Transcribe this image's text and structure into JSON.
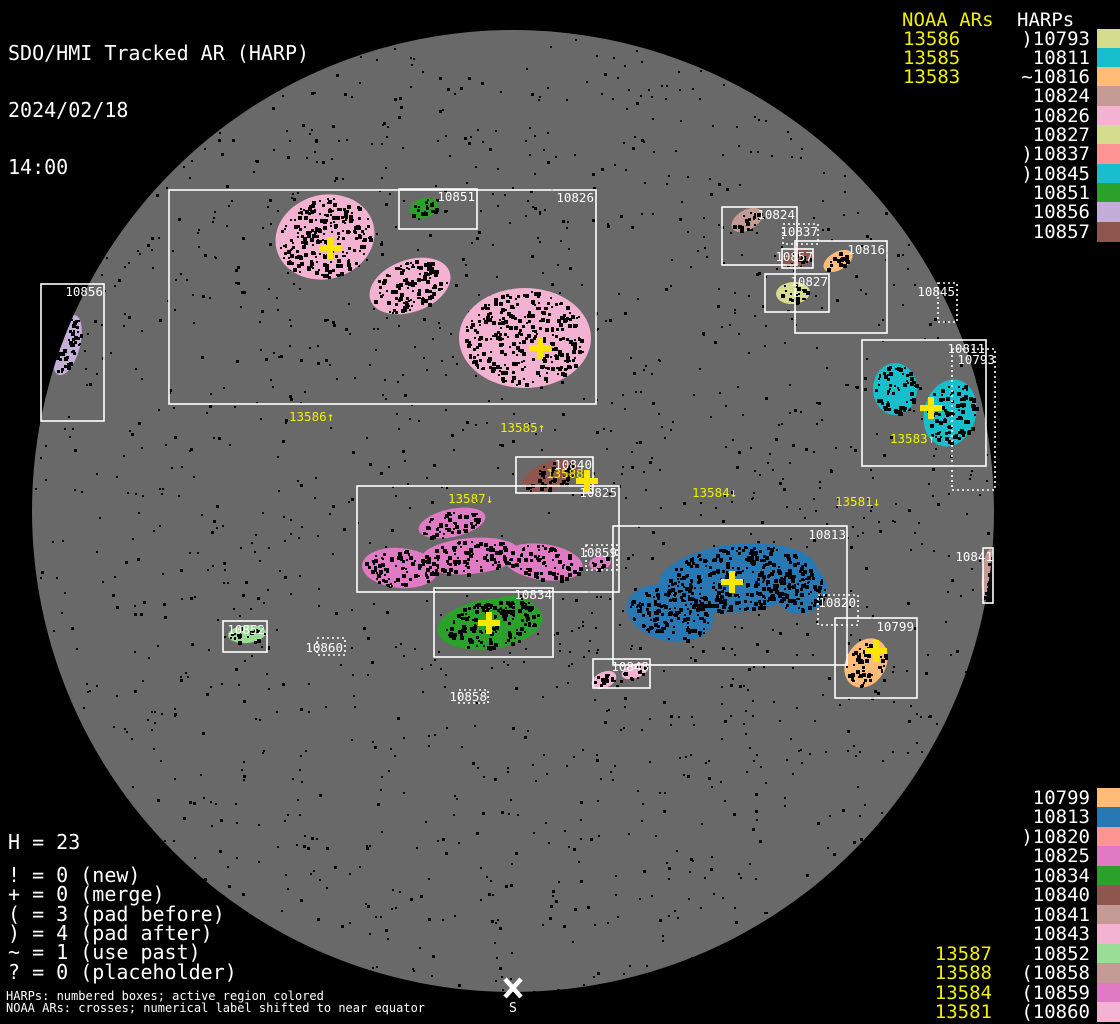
{
  "header": {
    "title": "SDO/HMI Tracked AR (HARP)",
    "date": "2024/02/18",
    "time": "14:00"
  },
  "columns": {
    "noaa_header": "NOAA ARs",
    "harp_header": "HARPs"
  },
  "colors": {
    "background": "#000000",
    "disk": "#696969",
    "box_stroke": "#ffffff",
    "noaa_yellow": "#f0f000",
    "cross_yellow": "#ffe600",
    "speckle": "#000000"
  },
  "disk": {
    "cx": 513,
    "cy": 511,
    "r": 481
  },
  "south": {
    "x": 513,
    "y": 988,
    "label": "S"
  },
  "stats": {
    "h": "H = 23",
    "flags": [
      "! = 0 (new)",
      "+ = 0 (merge)",
      "( = 3 (pad before)",
      ") = 4 (pad after)",
      "~ = 1 (use past)",
      "? = 0 (placeholder)"
    ]
  },
  "footer": {
    "line1": "HARPs: numbered boxes; active region colored",
    "line2": "NOAA ARs: crosses; numerical label shifted to near equator"
  },
  "legend_top": [
    {
      "noaa": "13586",
      "harp": ")10793",
      "color": "#d6dc8e"
    },
    {
      "noaa": "13585",
      "harp": "10811",
      "color": "#17becb"
    },
    {
      "noaa": "13583",
      "harp": "~10816",
      "color": "#ffbc78"
    },
    {
      "noaa": "",
      "harp": "10824",
      "color": "#c49a94"
    },
    {
      "noaa": "",
      "harp": "10826",
      "color": "#f4b2d2"
    },
    {
      "noaa": "",
      "harp": "10827",
      "color": "#d6dc8e"
    },
    {
      "noaa": "",
      "harp": ")10837",
      "color": "#ff9494"
    },
    {
      "noaa": "",
      "harp": ")10845",
      "color": "#17becb"
    },
    {
      "noaa": "",
      "harp": "10851",
      "color": "#2ba02b"
    },
    {
      "noaa": "",
      "harp": "10856",
      "color": "#c2aed6"
    },
    {
      "noaa": "",
      "harp": "10857",
      "color": "#8e564c"
    }
  ],
  "legend_bottom": [
    {
      "noaa": "",
      "harp": "10799",
      "color": "#ffbc78"
    },
    {
      "noaa": "",
      "harp": "10813",
      "color": "#2878b4"
    },
    {
      "noaa": "",
      "harp": ")10820",
      "color": "#ff9494"
    },
    {
      "noaa": "",
      "harp": "10825",
      "color": "#e07ac4"
    },
    {
      "noaa": "",
      "harp": "10834",
      "color": "#2ba02b"
    },
    {
      "noaa": "",
      "harp": "10840",
      "color": "#8e564c"
    },
    {
      "noaa": "",
      "harp": "10841",
      "color": "#c49a94"
    },
    {
      "noaa": "",
      "harp": "10843",
      "color": "#f4b2d2"
    },
    {
      "noaa": "13587",
      "harp": "10852",
      "color": "#9add96"
    },
    {
      "noaa": "13588",
      "harp": "(10858",
      "color": "#c49a94"
    },
    {
      "noaa": "13584",
      "harp": "(10859",
      "color": "#e07ac4"
    },
    {
      "noaa": "13581",
      "harp": "(10860",
      "color": "#f4b2d2"
    }
  ],
  "harps": [
    {
      "id": "10826",
      "box": [
        169,
        190,
        427,
        214
      ],
      "style": "solid",
      "label_x": 594,
      "label_y": 202,
      "color": "#f4b2d2",
      "ellipses": [
        [
          325,
          237,
          50,
          42,
          -15
        ],
        [
          410,
          286,
          42,
          26,
          -20
        ],
        [
          525,
          338,
          66,
          50,
          0
        ]
      ]
    },
    {
      "id": "10851",
      "box": [
        399,
        189,
        78,
        40
      ],
      "style": "solid",
      "label_x": 475,
      "label_y": 201,
      "color": "#2ba02b",
      "ellipses": [
        [
          424,
          208,
          15,
          10,
          -15
        ]
      ]
    },
    {
      "id": "10856",
      "box": [
        41,
        284,
        63,
        137
      ],
      "style": "solid",
      "label_x": 103,
      "label_y": 296,
      "color": "#c2aed6",
      "ellipses": [
        [
          67,
          345,
          13,
          31,
          15
        ]
      ]
    },
    {
      "id": "10824",
      "box": [
        722,
        207,
        75,
        58
      ],
      "style": "solid",
      "label_x": 795,
      "label_y": 219,
      "color": "#c49a94",
      "ellipses": [
        [
          747,
          220,
          17,
          10,
          -30
        ]
      ]
    },
    {
      "id": "10837",
      "box": [
        783,
        224,
        35,
        20
      ],
      "style": "dotted",
      "label_x": 818,
      "label_y": 236,
      "color": "#ff9494",
      "ellipses": []
    },
    {
      "id": "10857",
      "box": [
        782,
        249,
        31,
        19
      ],
      "style": "solid",
      "label_x": 813,
      "label_y": 261,
      "color": "#8e564c",
      "ellipses": [
        [
          798,
          258,
          16,
          8,
          -10
        ]
      ]
    },
    {
      "id": "10816",
      "box": [
        795,
        241,
        92,
        92
      ],
      "style": "solid",
      "label_x": 885,
      "label_y": 254,
      "color": "#ffbc78",
      "ellipses": [
        [
          838,
          261,
          16,
          9,
          -30
        ]
      ]
    },
    {
      "id": "10827",
      "box": [
        765,
        274,
        64,
        38
      ],
      "style": "solid",
      "label_x": 828,
      "label_y": 286,
      "color": "#d6dc8e",
      "ellipses": [
        [
          793,
          293,
          17,
          11,
          -5
        ]
      ]
    },
    {
      "id": "10845",
      "box": [
        938,
        283,
        19,
        39
      ],
      "style": "dotted",
      "label_x": 955,
      "label_y": 296,
      "color": "#17becb",
      "ellipses": []
    },
    {
      "id": "10811",
      "box": [
        862,
        340,
        124,
        126
      ],
      "style": "solid",
      "label_x": 985,
      "label_y": 353,
      "color": "#17becb",
      "ellipses": [
        [
          895,
          389,
          22,
          26,
          0
        ],
        [
          950,
          413,
          26,
          34,
          15
        ]
      ]
    },
    {
      "id": "10793",
      "box": [
        952,
        349,
        43,
        141
      ],
      "style": "dotted",
      "label_x": 995,
      "label_y": 364,
      "color": "#d6dc8e",
      "ellipses": []
    },
    {
      "id": "10840",
      "box": [
        516,
        457,
        77,
        36
      ],
      "style": "solid",
      "label_x": 592,
      "label_y": 469,
      "color": "#8e564c",
      "ellipses": [
        [
          550,
          476,
          29,
          14,
          -20
        ]
      ]
    },
    {
      "id": "10825",
      "box": [
        357,
        486,
        262,
        106
      ],
      "style": "solid",
      "label_x": 617,
      "label_y": 497,
      "color": "#e07ac4",
      "ellipses": [
        [
          452,
          523,
          34,
          14,
          -12
        ],
        [
          400,
          568,
          38,
          20,
          5
        ],
        [
          470,
          556,
          50,
          18,
          -5
        ],
        [
          543,
          562,
          40,
          18,
          8
        ]
      ]
    },
    {
      "id": "10859",
      "box": [
        586,
        545,
        31,
        25
      ],
      "style": "dotted",
      "label_x": 617,
      "label_y": 557,
      "color": "#e07ac4",
      "ellipses": [
        [
          600,
          563,
          11,
          7,
          -10
        ]
      ]
    },
    {
      "id": "10834",
      "box": [
        434,
        588,
        119,
        69
      ],
      "style": "solid",
      "label_x": 552,
      "label_y": 599,
      "color": "#2ba02b",
      "ellipses": [
        [
          490,
          624,
          53,
          25,
          -8
        ],
        [
          512,
          607,
          22,
          11,
          0
        ]
      ]
    },
    {
      "id": "10843",
      "box": [
        593,
        659,
        57,
        29
      ],
      "style": "solid",
      "label_x": 649,
      "label_y": 671,
      "color": "#f4b2d2",
      "ellipses": [
        [
          604,
          680,
          13,
          8,
          -25
        ],
        [
          635,
          671,
          14,
          7,
          -20
        ]
      ]
    },
    {
      "id": "10813",
      "box": [
        613,
        526,
        234,
        139
      ],
      "style": "solid",
      "label_x": 846,
      "label_y": 539,
      "color": "#2878b4",
      "ellipses": [
        [
          738,
          578,
          80,
          34,
          -6
        ],
        [
          670,
          613,
          44,
          28,
          12
        ],
        [
          800,
          589,
          27,
          25,
          0
        ]
      ]
    },
    {
      "id": "10820",
      "box": [
        818,
        595,
        40,
        30
      ],
      "style": "dotted",
      "label_x": 856,
      "label_y": 607,
      "color": "#ff9494",
      "ellipses": []
    },
    {
      "id": "10799",
      "box": [
        835,
        618,
        82,
        80
      ],
      "style": "solid",
      "label_x": 914,
      "label_y": 631,
      "color": "#ffbc78",
      "ellipses": [
        [
          866,
          663,
          20,
          26,
          30
        ]
      ]
    },
    {
      "id": "10852",
      "box": [
        223,
        621,
        44,
        31
      ],
      "style": "solid",
      "label_x": 265,
      "label_y": 634,
      "color": "#9add96",
      "ellipses": [
        [
          247,
          634,
          19,
          9,
          -5
        ]
      ]
    },
    {
      "id": "10860",
      "box": [
        317,
        638,
        28,
        17
      ],
      "style": "dotted",
      "label_x": 343,
      "label_y": 652,
      "color": "#f4b2d2",
      "ellipses": []
    },
    {
      "id": "10858",
      "box": [
        459,
        690,
        29,
        13
      ],
      "style": "dotted",
      "label_x": 487,
      "label_y": 701,
      "color": "#c49a94",
      "ellipses": []
    },
    {
      "id": "10841",
      "box": [
        983,
        548,
        10,
        55
      ],
      "style": "solid",
      "label_x": 993,
      "label_y": 561,
      "color": "#c49a94",
      "ellipses": [
        [
          988,
          575,
          6,
          26,
          5
        ]
      ]
    }
  ],
  "noaa_crosses": [
    [
      330,
      248
    ],
    [
      540,
      348
    ],
    [
      931,
      408
    ],
    [
      587,
      481
    ],
    [
      732,
      582
    ],
    [
      489,
      623
    ],
    [
      876,
      651
    ]
  ],
  "ar_labels": [
    {
      "text": "13586↑",
      "x": 289,
      "y": 421
    },
    {
      "text": "13585↑",
      "x": 500,
      "y": 432
    },
    {
      "text": "13583↑",
      "x": 890,
      "y": 443
    },
    {
      "text": "13588↓",
      "x": 546,
      "y": 478
    },
    {
      "text": "13587↓",
      "x": 448,
      "y": 503
    },
    {
      "text": "13584↓",
      "x": 692,
      "y": 497
    },
    {
      "text": "13581↓",
      "x": 835,
      "y": 506
    }
  ],
  "chart_data": {
    "type": "scatter",
    "title": "SDO/HMI Tracked AR (HARP) 2024/02/18 14:00",
    "description": "Solar disk map: HARP bounding boxes (numbered, active regions colored) and NOAA AR crosses with labels shifted toward equator",
    "harp_total": 23,
    "flag_counts": {
      "new": 0,
      "merge": 0,
      "pad_before": 3,
      "pad_after": 4,
      "use_past": 1,
      "placeholder": 0
    },
    "harps": [
      {
        "id": 10793,
        "flag": ")"
      },
      {
        "id": 10811,
        "flag": ""
      },
      {
        "id": 10816,
        "flag": "~"
      },
      {
        "id": 10824,
        "flag": ""
      },
      {
        "id": 10826,
        "flag": ""
      },
      {
        "id": 10827,
        "flag": ""
      },
      {
        "id": 10837,
        "flag": ")"
      },
      {
        "id": 10845,
        "flag": ")"
      },
      {
        "id": 10851,
        "flag": ""
      },
      {
        "id": 10856,
        "flag": ""
      },
      {
        "id": 10857,
        "flag": ""
      },
      {
        "id": 10799,
        "flag": ""
      },
      {
        "id": 10813,
        "flag": ""
      },
      {
        "id": 10820,
        "flag": ")"
      },
      {
        "id": 10825,
        "flag": ""
      },
      {
        "id": 10834,
        "flag": ""
      },
      {
        "id": 10840,
        "flag": ""
      },
      {
        "id": 10841,
        "flag": ""
      },
      {
        "id": 10843,
        "flag": ""
      },
      {
        "id": 10852,
        "flag": ""
      },
      {
        "id": 10858,
        "flag": "("
      },
      {
        "id": 10859,
        "flag": "("
      },
      {
        "id": 10860,
        "flag": "("
      }
    ],
    "noaa_ars": [
      {
        "id": 13586,
        "shift": "up"
      },
      {
        "id": 13585,
        "shift": "up"
      },
      {
        "id": 13583,
        "shift": "up"
      },
      {
        "id": 13588,
        "shift": "down"
      },
      {
        "id": 13587,
        "shift": "down"
      },
      {
        "id": 13584,
        "shift": "down"
      },
      {
        "id": 13581,
        "shift": "down"
      }
    ]
  }
}
